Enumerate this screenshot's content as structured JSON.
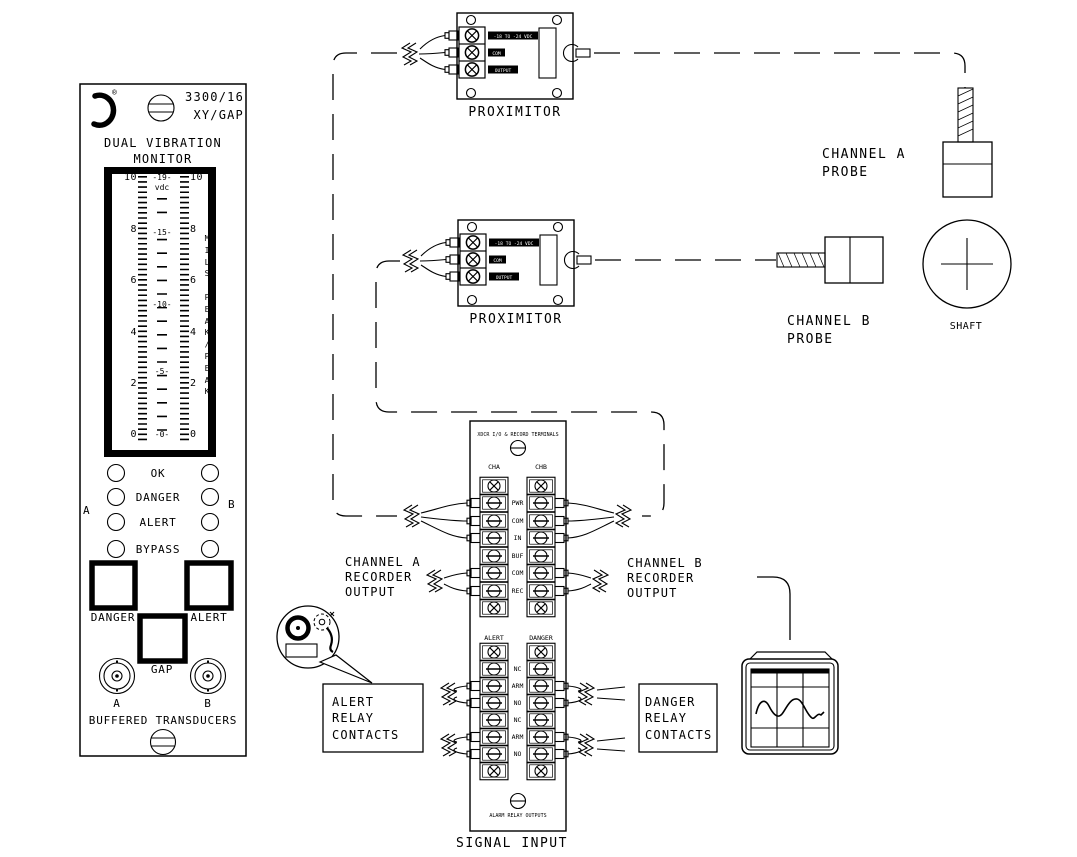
{
  "monitor": {
    "registered": "®",
    "model": "3300/16",
    "variant": "XY/GAP",
    "title1": "DUAL VIBRATION",
    "title2": "MONITOR",
    "meter": {
      "left": [
        "10",
        "8",
        "6",
        "4",
        "2",
        "0"
      ],
      "center": [
        "-19-",
        "vdc",
        "-15-",
        "-10-",
        "-5-",
        "-0-"
      ],
      "right": [
        "10",
        "8",
        "6",
        "4",
        "2",
        "0"
      ],
      "side": "M\nI\nL\nS\n\nP\nE\nA\nK\n/\nP\nE\nA\nK"
    },
    "leds": [
      "OK",
      "DANGER",
      "ALERT",
      "BYPASS"
    ],
    "side_a": "A",
    "side_b": "B",
    "danger_button": "DANGER",
    "alert_button": "ALERT",
    "gap_button": "GAP",
    "bnc_a": "A",
    "bnc_b": "B",
    "buffered": "BUFFERED TRANSDUCERS"
  },
  "proximitor": {
    "caption": "PROXIMITOR",
    "terminals": [
      "-18 TO -24 VDC",
      "COM",
      "OUTPUT"
    ]
  },
  "probes": {
    "a1": "CHANNEL A",
    "a2": "PROBE",
    "b1": "CHANNEL B",
    "b2": "PROBE",
    "shaft": "SHAFT"
  },
  "signal_input": {
    "top_note": "XDCR I/O & RECORD TERMINALS",
    "cha": "CHA",
    "chb": "CHB",
    "xdcr_rows": [
      "PWR",
      "COM",
      "IN",
      "BUF",
      "COM",
      "REC"
    ],
    "alert_col": "ALERT",
    "danger_col": "DANGER",
    "relay_rows": [
      "NC",
      "ARM",
      "NO",
      "NC",
      "ARM",
      "NO"
    ],
    "bottom_note": "ALARM RELAY OUTPUTS",
    "caption": "SIGNAL INPUT"
  },
  "labels": {
    "cha_rec": [
      "CHANNEL A",
      "RECORDER",
      "OUTPUT"
    ],
    "chb_rec": [
      "CHANNEL B",
      "RECORDER",
      "OUTPUT"
    ],
    "alert_box": [
      "ALERT",
      "RELAY",
      "CONTACTS"
    ],
    "danger_box": [
      "DANGER",
      "RELAY",
      "CONTACTS"
    ]
  },
  "colors": {
    "ink": "#000000",
    "paper": "#ffffff"
  }
}
